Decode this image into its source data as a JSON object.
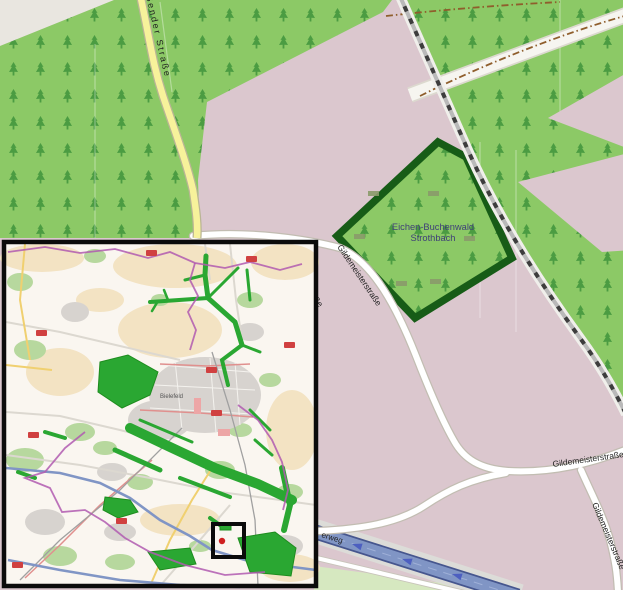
{
  "main_map": {
    "reserve": {
      "name_line1": "Eichen-Buchenwald",
      "name_line2": "Strothbach",
      "border_color": "#175c17",
      "label_color": "#3e3e78"
    },
    "streets": {
      "north_road": "Sender Straße",
      "gildemeister_upper": "Gildemeisterstraße",
      "gildemeister_east": "Gildemeisterstraße",
      "gildemeister_south": "Gildemeisterstraße",
      "street_fragment": "aße",
      "motorway_fragment": "erweg"
    },
    "colors": {
      "forest": "#8cc966",
      "tree_symbol": "#44973e",
      "farmland_pink": "#dbc7ce",
      "bare_beige": "#e9e6e0",
      "road_fill": "#ffffff",
      "yellow_road": "#f7f29b",
      "railway_dash": "#3d3d3d",
      "motorway_blue": "#8095c5",
      "track_brown": "#8f5e2c",
      "grass": "#d6e8c0"
    }
  },
  "inset_map": {
    "city_label": "Bielefeld",
    "marker": {
      "type": "location-rectangle",
      "outline_color": "#0b0b0b",
      "dot_color": "#cf2020"
    },
    "colors": {
      "highlight_green": "#2aa732",
      "woodland_green": "#b7d89e",
      "boundary_purple": "#b05ab0",
      "farmland_tan": "#f3e3c3",
      "urban_gray": "#d7d3cf",
      "road_red": "#e0908e",
      "motorway_blue": "#8095c5",
      "shield_red": "#d04040"
    }
  }
}
